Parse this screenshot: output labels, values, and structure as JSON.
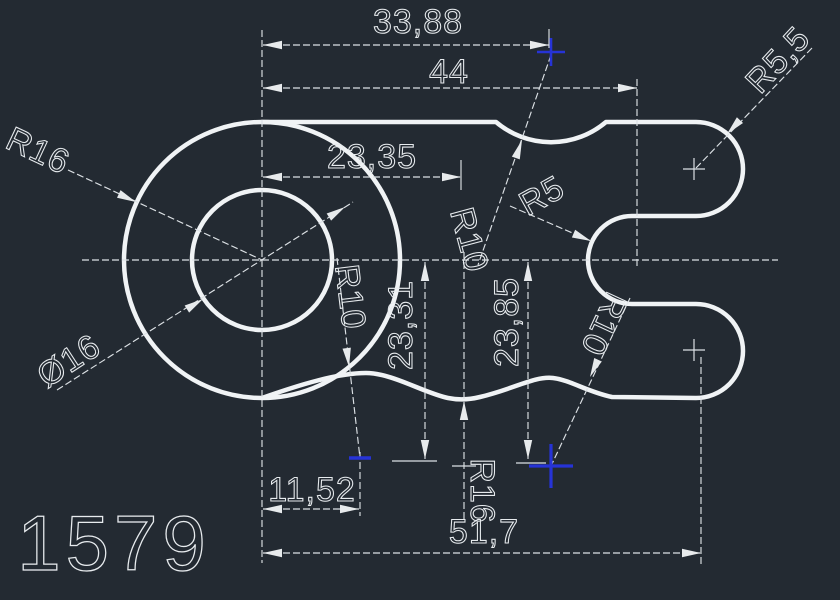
{
  "canvas": {
    "background_color": "#232a32",
    "line_color": "#e7ebee",
    "grip_color": "#2633d6"
  },
  "title_block": {
    "drawing_number": "1579"
  },
  "dims": {
    "w3388": "33,88",
    "w44": "44",
    "w2335": "23,35",
    "w1152": "11,52",
    "w517": "51,7",
    "h2331": "23,31",
    "h2385": "23,85",
    "r16_left": "R16",
    "d16": "Ø16",
    "r10_top": "R10",
    "r10_left": "R10",
    "r10_right": "R10",
    "r5": "R5",
    "r55": "R5,5",
    "r16_bottom": "R16"
  }
}
